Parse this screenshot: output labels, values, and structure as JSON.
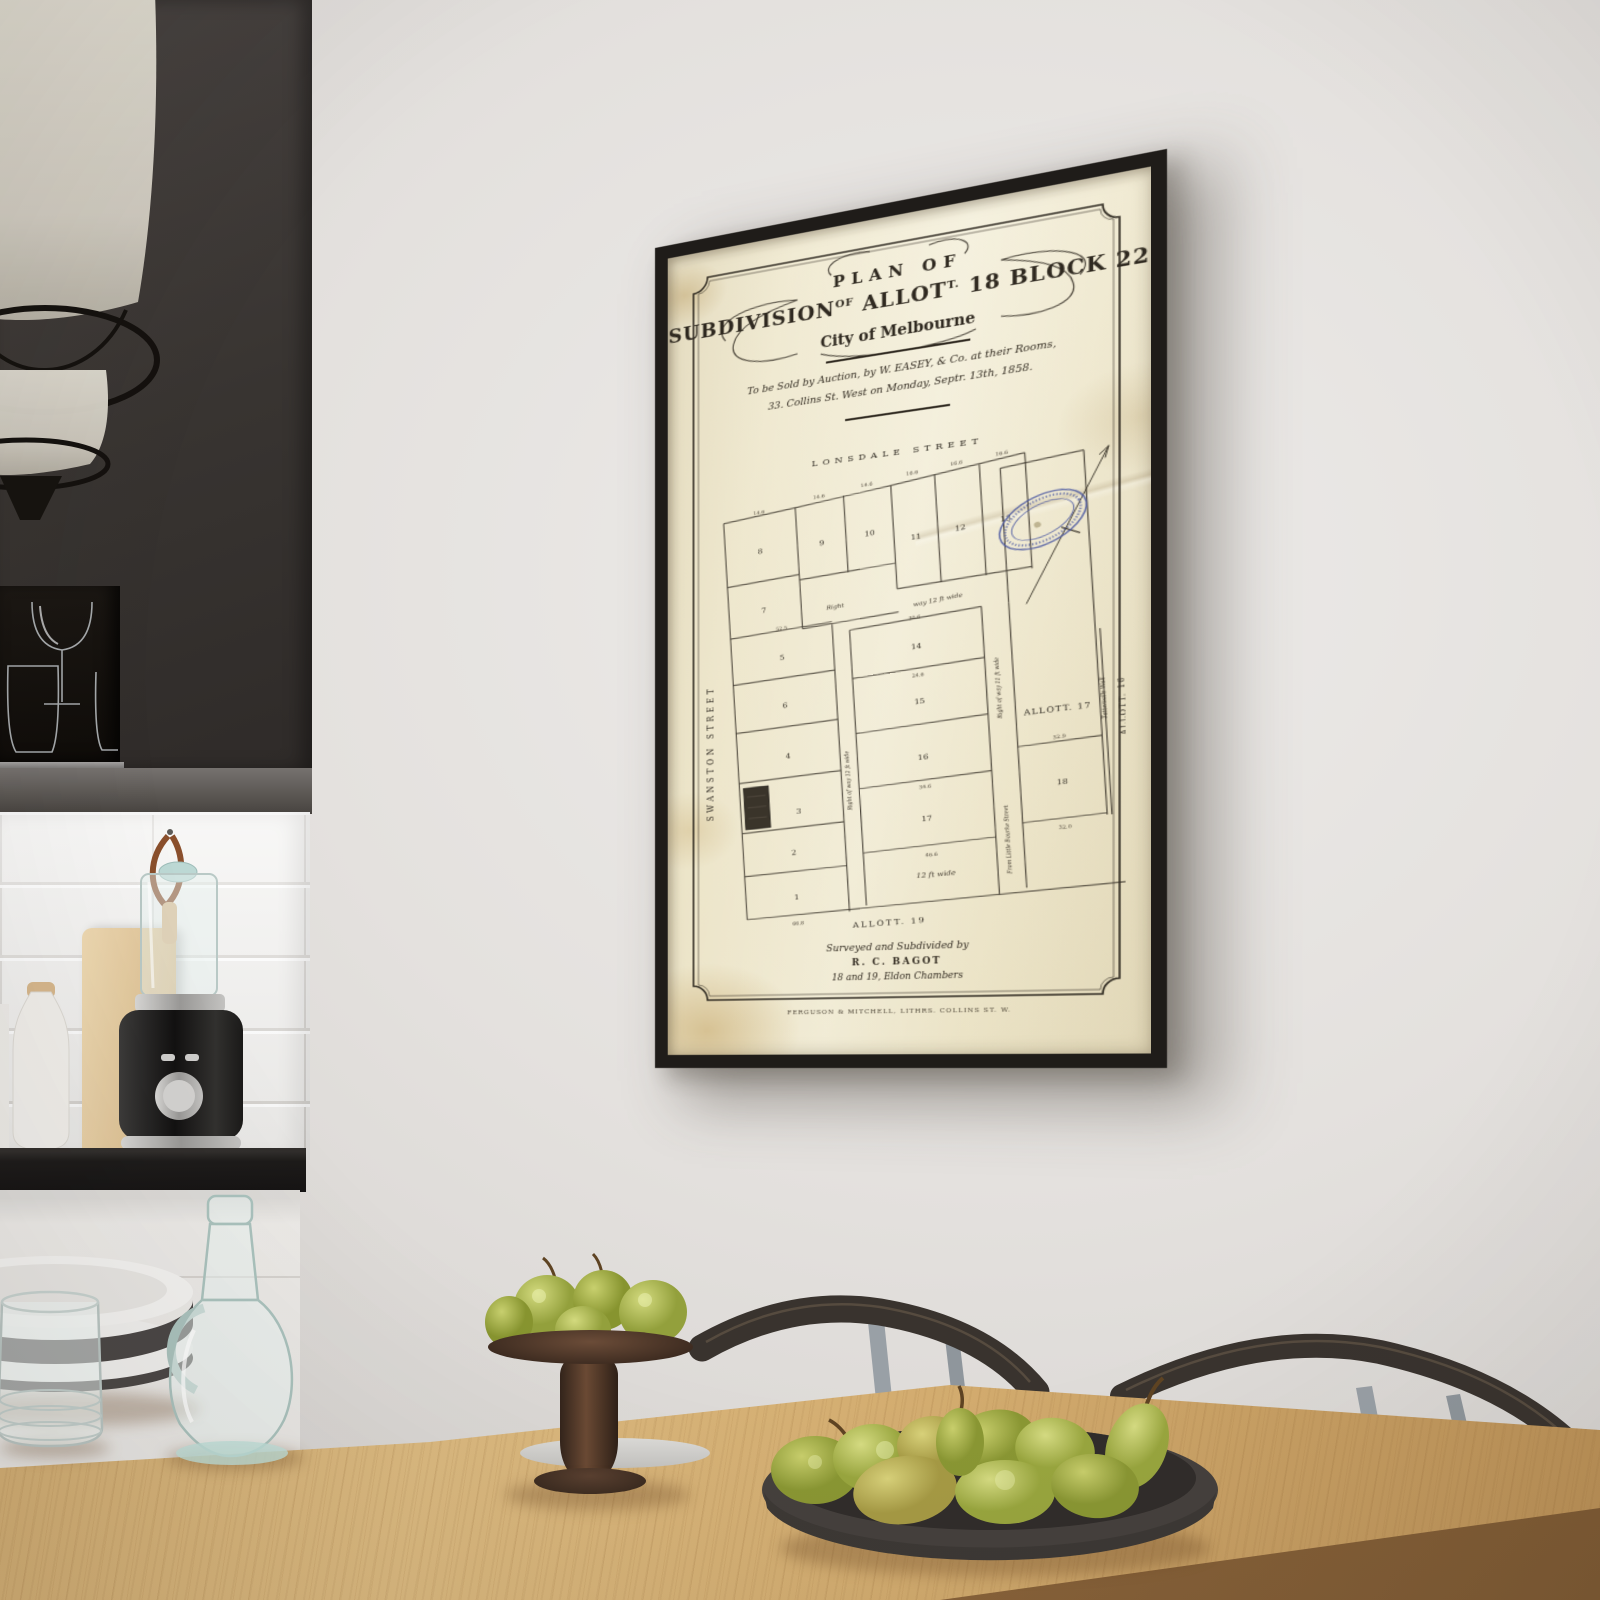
{
  "scene": {
    "setting": "kitchen-dining interior, framed antique subdivision plan hanging on wall",
    "wall_color": "#e6e3e0",
    "cabinet_color": "#3a3633",
    "table_wood_color": "#cda76c",
    "frame_color": "#1f1c19",
    "paper_color": "#efe8d0",
    "stamp_color": "#4a57a3",
    "pear_color": "#a9b44c",
    "chair_color": "#39332e"
  },
  "poster": {
    "title": {
      "line1": "PLAN OF",
      "line2_a": "SUBDIVISION",
      "line2_a_sup": "OF",
      "line2_b": "ALLOT",
      "line2_b_sup": "T.",
      "line2_b_num": "18",
      "line2_c": "BLOCK",
      "line2_c_num": "22",
      "line3": "City of Melbourne"
    },
    "auction": {
      "line1": "To be Sold by Auction, by W. EASEY, & Co. at their Rooms,",
      "line2": "33. Collins St. West on Monday, Septr. 13th, 1858."
    },
    "map": {
      "streets": {
        "lonsdale": "LONSDALE STREET",
        "swanston": "SWANSTON STREET"
      },
      "lots": [
        "1",
        "2",
        "3",
        "4",
        "5",
        "6",
        "7",
        "8",
        "9",
        "10",
        "11",
        "12",
        "13",
        "14",
        "15",
        "16",
        "17",
        "18"
      ],
      "areas": {
        "allot17": "ALLOTT. 17",
        "allot16": "ALLOTT. 16",
        "allot19": "ALLOTT. 19"
      },
      "annotations": {
        "right_word": "Right",
        "way12": "way 12 ft wide",
        "row12": "Right of way 12 ft wide",
        "row11": "Right of way 11 ft wide",
        "wide12": "12 ft wide",
        "little_bourke": "From Little Bourke Street",
        "tattersalls": "Tattersalls Wall"
      },
      "dims": [
        "14.6",
        "14.6",
        "14.6",
        "16.6",
        "16.6",
        "16.6",
        "30.6",
        "24.6",
        "34.6",
        "46.6",
        "66.8",
        "32.0",
        "52.5",
        "32.9"
      ],
      "stamp": "blue oval library stamp (illegible)"
    },
    "footer": {
      "line1": "Surveyed and Subdivided by",
      "line2": "R. C. BAGOT",
      "line3": "18 and 19, Eldon Chambers",
      "imprint": "FERGUSON & MITCHELL, LITHRS. COLLINS ST. W."
    }
  }
}
